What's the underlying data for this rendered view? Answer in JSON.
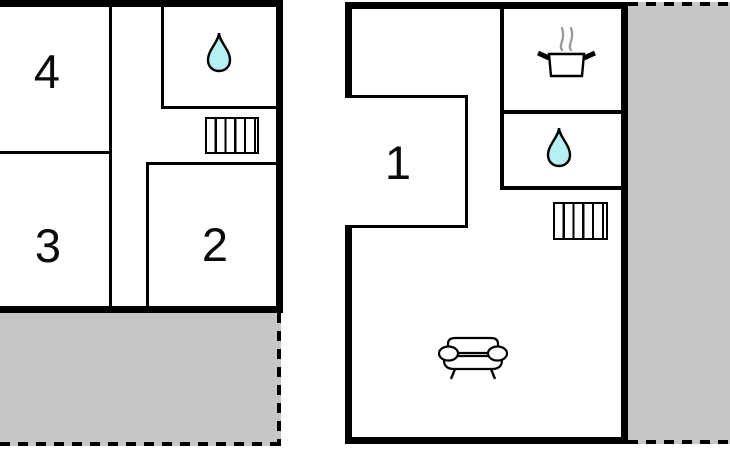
{
  "canvas": {
    "width": 730,
    "height": 450
  },
  "colors": {
    "background": "#ffffff",
    "wall": "#000000",
    "terrace_fill": "#c6c6c6",
    "water_drop_fill": "#b5f1f3",
    "steam": "#999999"
  },
  "plans": [
    {
      "name": "left-floor-plan",
      "rooms": [
        {
          "label": "4"
        },
        {
          "label": "3"
        },
        {
          "label": "2"
        }
      ],
      "icons": [
        "water-drop-icon",
        "stairs-icon"
      ],
      "areas": [
        "terrace"
      ]
    },
    {
      "name": "right-floor-plan",
      "rooms": [
        {
          "label": "1"
        }
      ],
      "icons": [
        "cooking-pot-icon",
        "water-drop-icon",
        "stairs-icon",
        "sofa-icon"
      ],
      "areas": [
        "terrace"
      ]
    }
  ]
}
